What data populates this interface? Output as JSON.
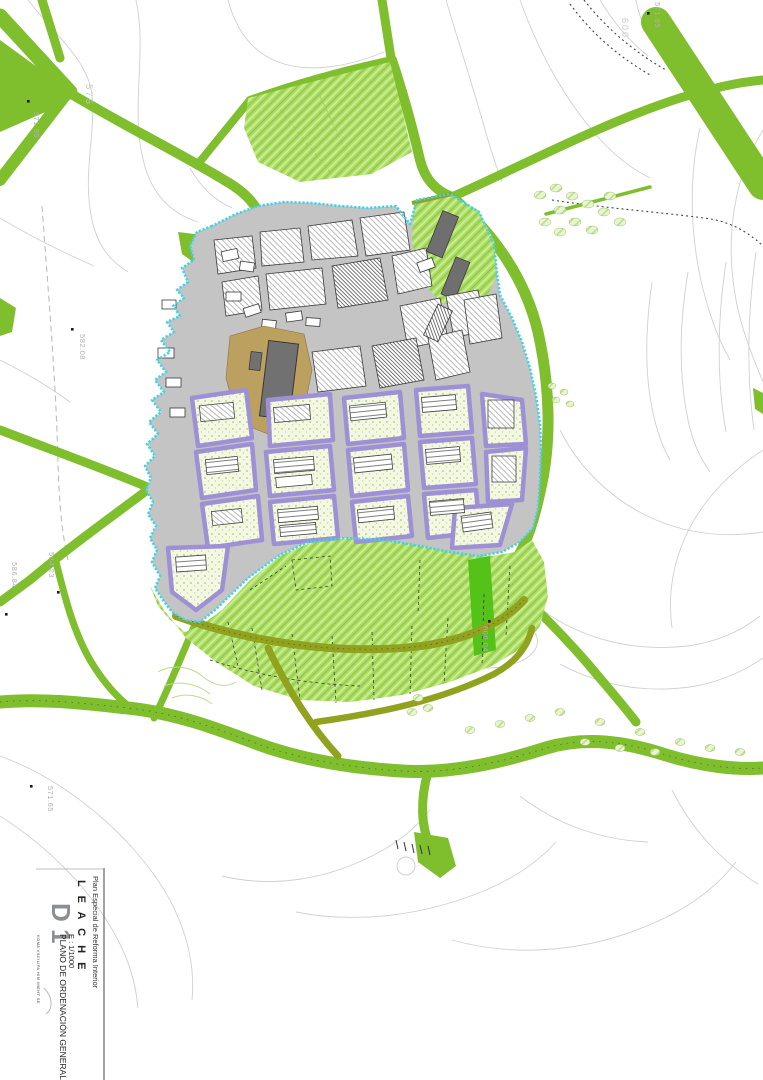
{
  "title_block": {
    "project": "Plan Especial de Reforma Interior",
    "municipality": "L E A C H E",
    "sheet_code": "D 1",
    "sheet_title": "PLANO DE ORDENACIÓN GENERAL.-",
    "scale": "E : 1/1000",
    "fine_print": "KOMA VSCILIPA HIM IMEHT SE"
  },
  "map": {
    "contour_labels": [
      {
        "text": "575"
      },
      {
        "text": "600"
      }
    ],
    "elevation_points": [
      {
        "label": "571.85"
      },
      {
        "label": "571.99"
      },
      {
        "label": "582.08"
      },
      {
        "label": "584.23"
      },
      {
        "label": "586.84"
      },
      {
        "label": "571.65"
      },
      {
        "label": "600.04"
      }
    ],
    "colors": {
      "rural_road_green": "#7FBE2D",
      "zone_road_olive": "#91A21F",
      "green_zone_fill": "#A9DB60",
      "urban_boundary_cyan": "#3FD3E7",
      "residential_block_purple": "#9D90D5",
      "street_gray": "#C4C4C4",
      "church_plaza_tan": "#BCA05F",
      "building_dark_gray": "#6F6F6F",
      "contour_gray": "#D0D0D0"
    }
  }
}
